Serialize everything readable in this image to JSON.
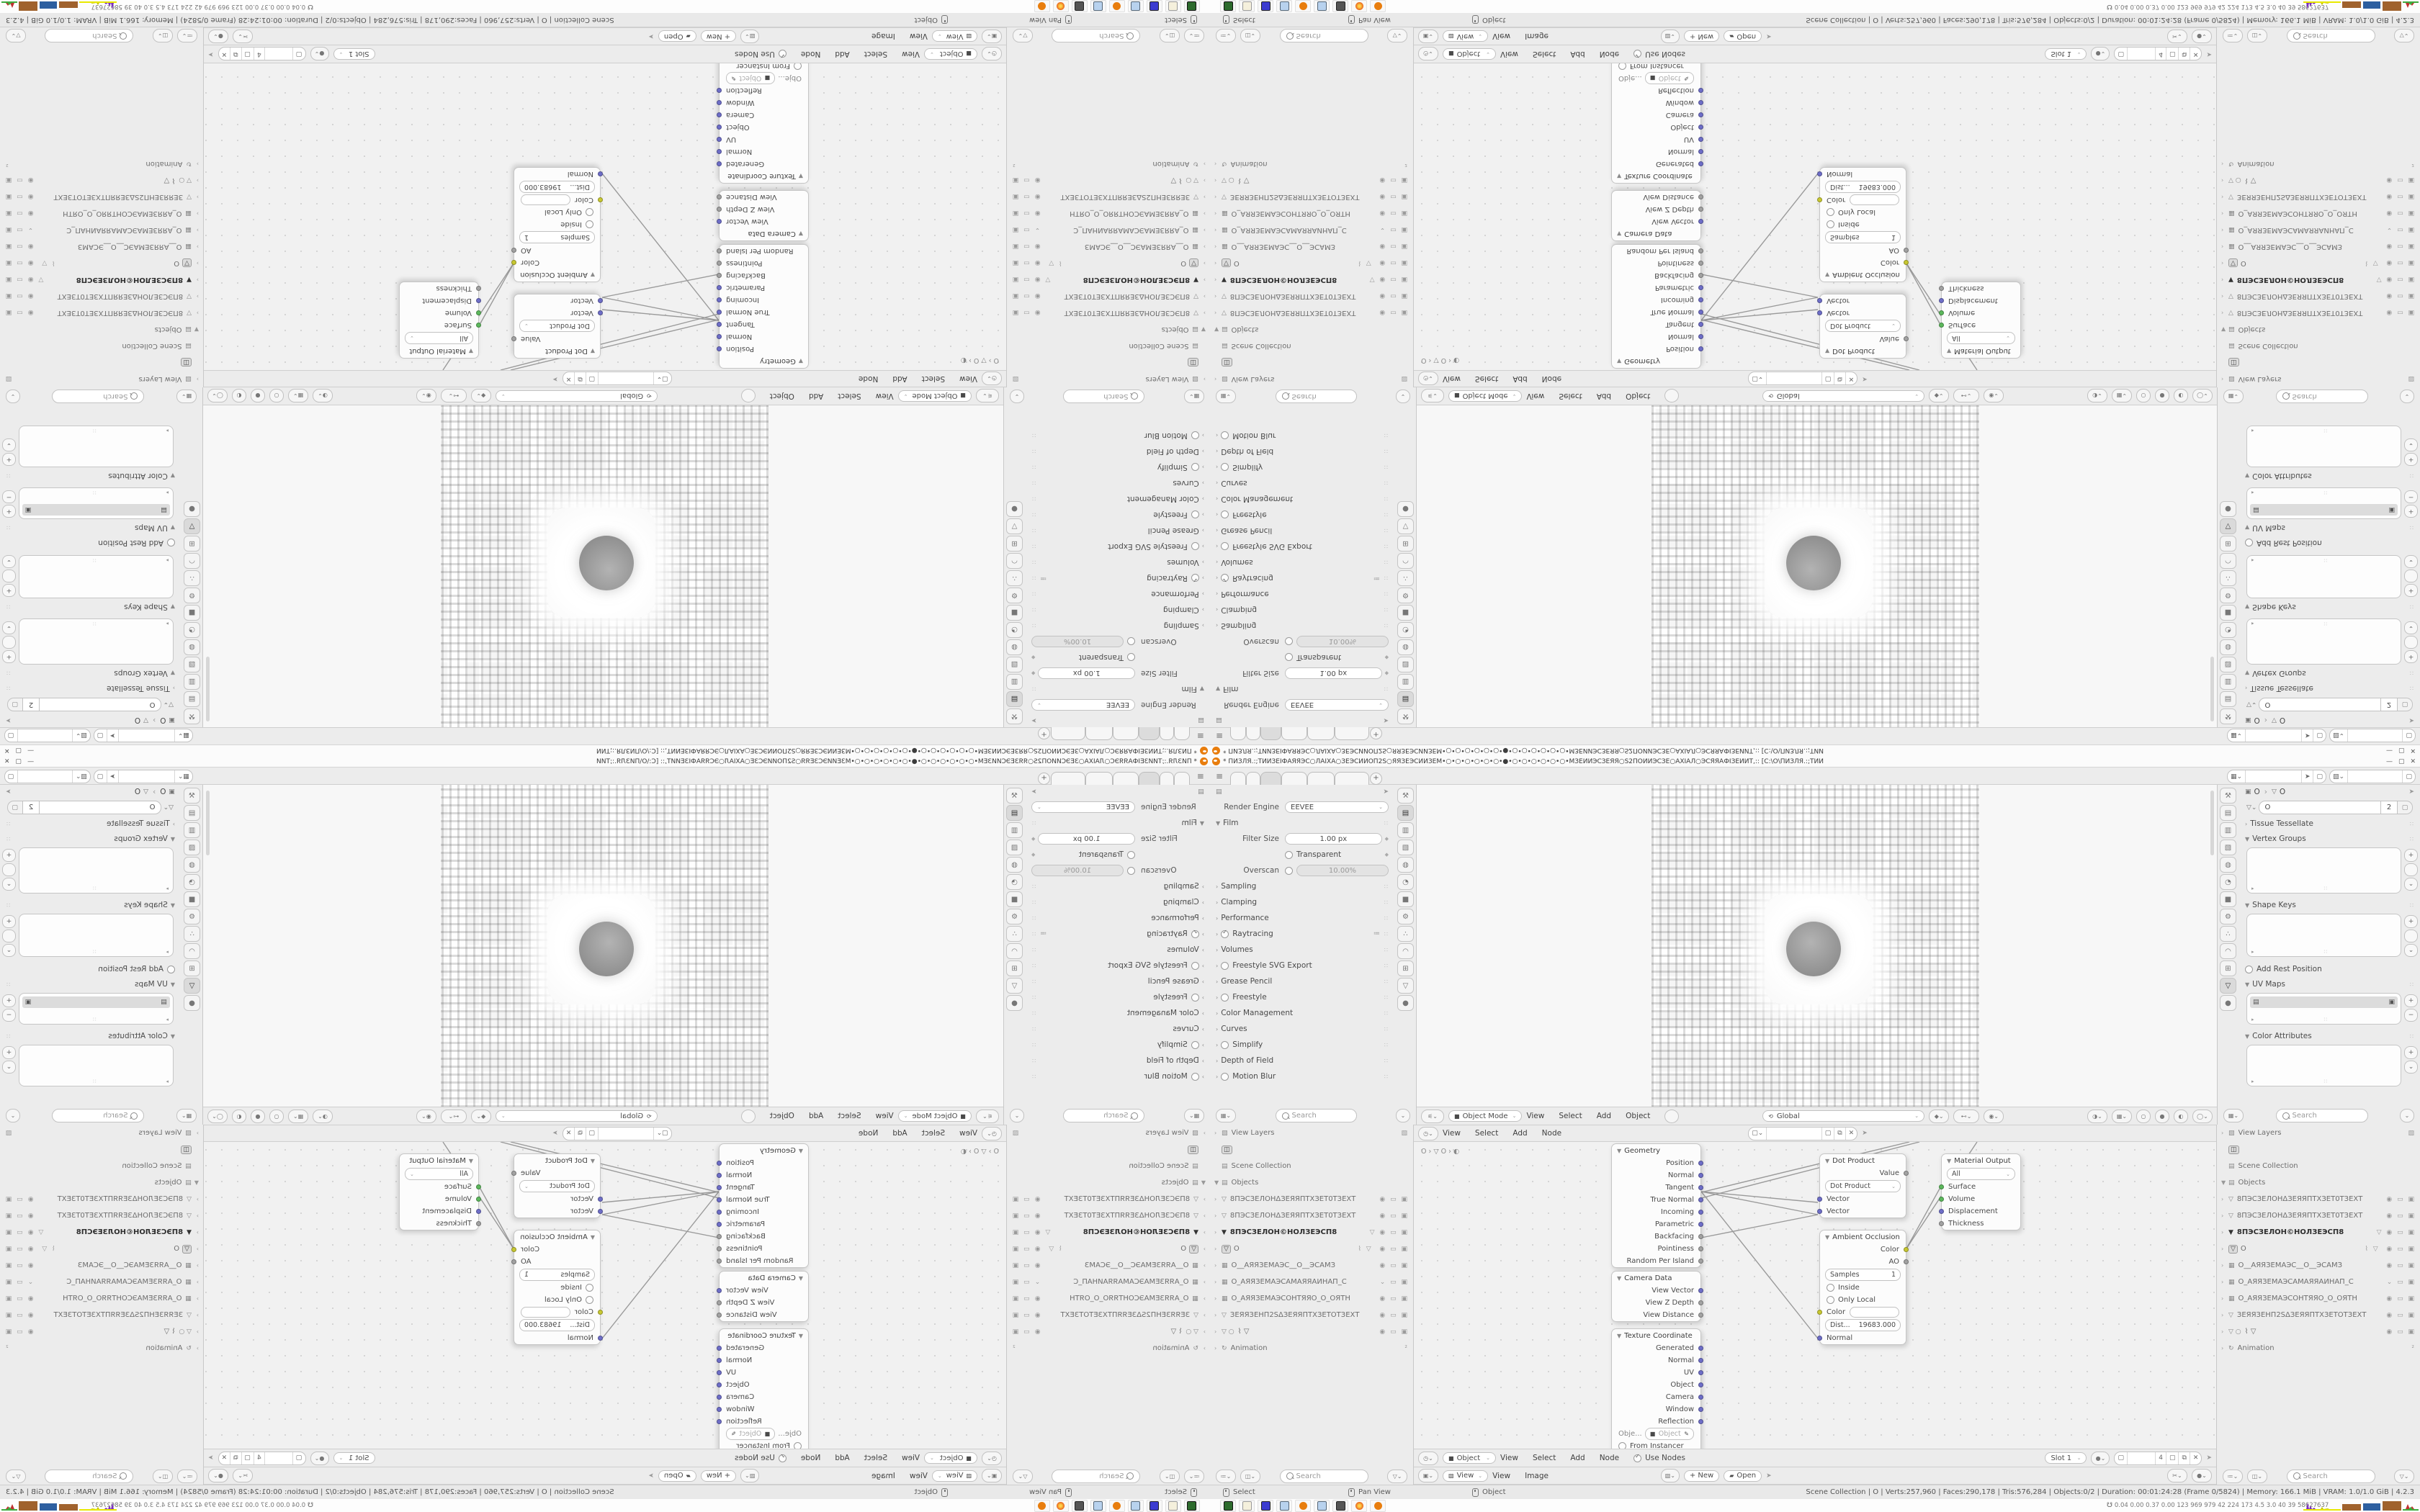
{
  "window": {
    "title": "* ПИЗЛЯ.:;ТИИЗЕІФАЯЯЭС○ЛАІХА○ЗЕЭСИИОП2Ѕ○ЯЯЗЕЭСИИЗЕМ•○•○•○•○•○•○•●•○•○•○•○•○•○•МЗЕИИЭСЗЕЯЯ○Ѕ2ПОИИЭСЗЕ○АХІАЛ○ЭСЯЯАФІЗЕИИТ,:: [С:\\О\\ПИЗЛЯ.:;ТИИ",
    "minimize": "—",
    "maximize": "▢",
    "close": "✕"
  },
  "topbar": {
    "menu_icon": "≡",
    "new_tab": "+"
  },
  "props_left": {
    "render_engine_label": "Render Engine",
    "render_engine_value": "EEVEE",
    "film_label": "Film",
    "filter_size_label": "Filter Size",
    "filter_size_value": "1.00 px",
    "transparent_label": "Transparent",
    "overscan_label": "Overscan",
    "overscan_value": "10.00%",
    "sections": [
      {
        "label": "Sampling"
      },
      {
        "label": "Clamping"
      },
      {
        "label": "Performance"
      },
      {
        "label": "Raytracing"
      },
      {
        "label": "Volumes"
      },
      {
        "label": "Freestyle SVG Export"
      },
      {
        "label": "Grease Pencil"
      },
      {
        "label": "Freestyle"
      },
      {
        "label": "Color Management"
      },
      {
        "label": "Curves"
      },
      {
        "label": "Simplify"
      },
      {
        "label": "Depth of Field"
      },
      {
        "label": "Motion Blur"
      }
    ],
    "search_placeholder": "Search"
  },
  "viewport": {
    "mode": "Object Mode",
    "menu_view": "View",
    "menu_select": "Select",
    "menu_add": "Add",
    "menu_object": "Object",
    "orientation": "Global"
  },
  "node_header_a": {
    "menu_view": "View",
    "menu_select": "Select",
    "menu_add": "Add",
    "menu_node": "Node"
  },
  "node_editor": {
    "path": "O  ›  ▽ O  ›  ◐"
  },
  "nodes": {
    "geometry": {
      "title": "Geometry",
      "outputs": [
        "Position",
        "Normal",
        "Tangent",
        "True Normal",
        "Incoming",
        "Parametric",
        "Backfacing",
        "Pointiness",
        "Random Per Island"
      ]
    },
    "camera_data": {
      "title": "Camera Data",
      "outputs": [
        "View Vector",
        "View Z Depth",
        "View Distance"
      ]
    },
    "texture_coordinate": {
      "title": "Texture Coordinate",
      "outputs": [
        "Generated",
        "Normal",
        "UV",
        "Object",
        "Camera",
        "Window",
        "Reflection"
      ],
      "object_label": "Obje...",
      "object_value": "Object",
      "from_instancer": "From Instancer"
    },
    "dot_product": {
      "title": "Dot Product",
      "output_value": "Value",
      "operation": "Dot Product",
      "input_1": "Vector",
      "input_2": "Vector"
    },
    "ambient_occlusion": {
      "title": "Ambient Occlusion",
      "output_color": "Color",
      "output_ao": "AO",
      "samples_label": "Samples",
      "samples_value": "1",
      "inside_label": "Inside",
      "only_local_label": "Only Local",
      "color_input": "Color",
      "dist_label": "Dist...",
      "dist_value": "19683.000",
      "normal_input": "Normal"
    },
    "material_output": {
      "title": "Material Output",
      "target": "All",
      "input_surface": "Surface",
      "input_volume": "Volume",
      "input_displacement": "Displacement",
      "input_thickness": "Thickness"
    }
  },
  "outliner": {
    "view_layers": "View Layers",
    "scene_collection": "Scene Collection",
    "objects": "Objects",
    "animation": "Animation",
    "items": [
      {
        "name": "8ПЭСЗЕЛОНΔЗЕЯЯПТХЗЕТ0ТЗЕХТ"
      },
      {
        "name": "8ПЭСЗЕЛОНΔЗЕЯЯПТХЗЕТ0ТЗЕХТ"
      },
      {
        "name": "8ПЭСЗЕЛОН©НОЛЗЕЭСП8"
      },
      {
        "name": "O"
      },
      {
        "name": "O__АЯЯЗЕМАЭС__О__ЭСАМЗ"
      },
      {
        "name": "O_АЯЯЗЕМАЭСАМАЯЯАИНАП_С"
      },
      {
        "name": "O_АЯЯЗЕМАЭСОНТЯЯО_О_ОЯТН"
      },
      {
        "name": "ЗЕЯЯЗЕНП2SΔЗЕЯЯПТХЗЕТОТЗЕХТ"
      },
      {
        "name": ""
      }
    ],
    "search_placeholder": "Search"
  },
  "props_right": {
    "breadcrumb_object": "O",
    "breadcrumb_data": "O",
    "name_value": "O",
    "users": "2",
    "tissue_tessellate": "Tissue Tessellate",
    "vertex_groups": "Vertex Groups",
    "shape_keys": "Shape Keys",
    "add_rest_position": "Add Rest Position",
    "uv_maps": "UV Maps",
    "color_attributes": "Color Attributes",
    "add_btn": "+",
    "remove_btn": "−",
    "search_placeholder": "Search"
  },
  "node_header_b": {
    "object": "Object",
    "menu_view": "View",
    "menu_select": "Select",
    "menu_add": "Add",
    "menu_node": "Node",
    "use_nodes": "Use Nodes",
    "slot": "Slot 1",
    "material_users": "4"
  },
  "image_header": {
    "mode": "View",
    "menu_view": "View",
    "menu_image": "Image",
    "new_label": "+ New",
    "open_label": "Open"
  },
  "statusbar": {
    "hint_select": "Select",
    "hint_pan": "Pan View",
    "hint_object": "Object",
    "stats": "Scene Collection | O | Verts:257,960 | Faces:290,178 | Tris:576,284 | Objects:0/2 | Duration: 00:01:24:28 (Frame 0/5824) | Memory: 166.1 MiB | VRAM: 1.0/1.0 GiB | 4.2.3"
  },
  "taskbar": {
    "stats": "0.04 0.00 0.37 0.00 123  969  979  42  224  173  4.5  3.0  40  39  58627637"
  },
  "colors": {
    "blender_orange": "#e87d0d",
    "socket_vector": "#6e6ec8",
    "socket_shader": "#5cb85c",
    "socket_color": "#c8c832",
    "socket_value": "#a2a2a2",
    "hist_purple": "#7b2fbe",
    "hist_yellow": "#e8e800",
    "hist_brown": "#a0622d",
    "hist_blue": "#2d5fa0",
    "hist_green": "#3faa3f",
    "hist_red": "#c03030"
  }
}
